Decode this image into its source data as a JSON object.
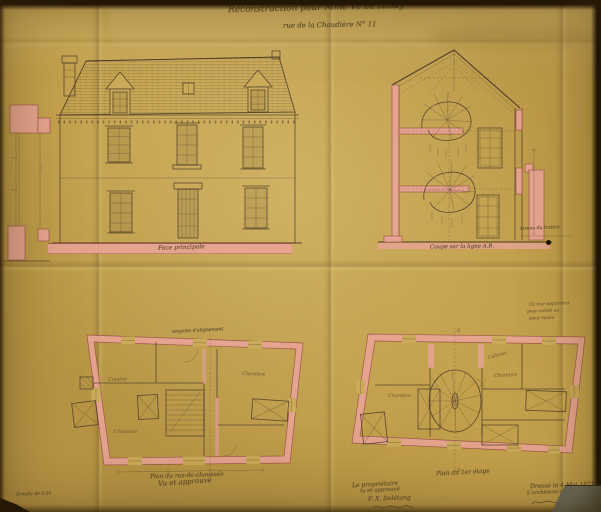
{
  "document": {
    "title_line1": "Reconstruction pour Mme Ve de Athay",
    "title_line2": "rue de la Chaudière N° 11"
  },
  "elevation": {
    "caption": "Face principale"
  },
  "cross_section": {
    "caption": "Coupe sur la ligne A.B.",
    "ground_note": "niveau du trottoir"
  },
  "plan_ground": {
    "caption": "Plan du rez-de-chaussée",
    "alignment_note": "emprise d'alignement",
    "rooms": [
      "Cuisine",
      "Chambre",
      "Chambre"
    ]
  },
  "plan_first": {
    "caption": "Plan du 1er étage",
    "rooms": [
      "Chambre",
      "Chambre",
      "Cabinet"
    ],
    "section_letter": "B",
    "margin_note": [
      "Ce mur appartient",
      "pour moitié au",
      "sieur voisin"
    ]
  },
  "annotations": {
    "scale_note": "Échelle de 0,01",
    "approval_note": "Vu et approuvé",
    "owner_block": [
      "Le propriétaire",
      "lu et approuvé",
      "F. X. Delétang"
    ],
    "architect_block": [
      "Dressé le 4 Mai 1871",
      "L'architecte soussigné"
    ]
  },
  "colors": {
    "paper": "#c3a04c",
    "wash_pink": "#e9a496",
    "ink": "#4a3826",
    "handwriting": "#5e4b2c",
    "photo_edge": "#170e04",
    "table_corner": "#5c5d4f"
  }
}
